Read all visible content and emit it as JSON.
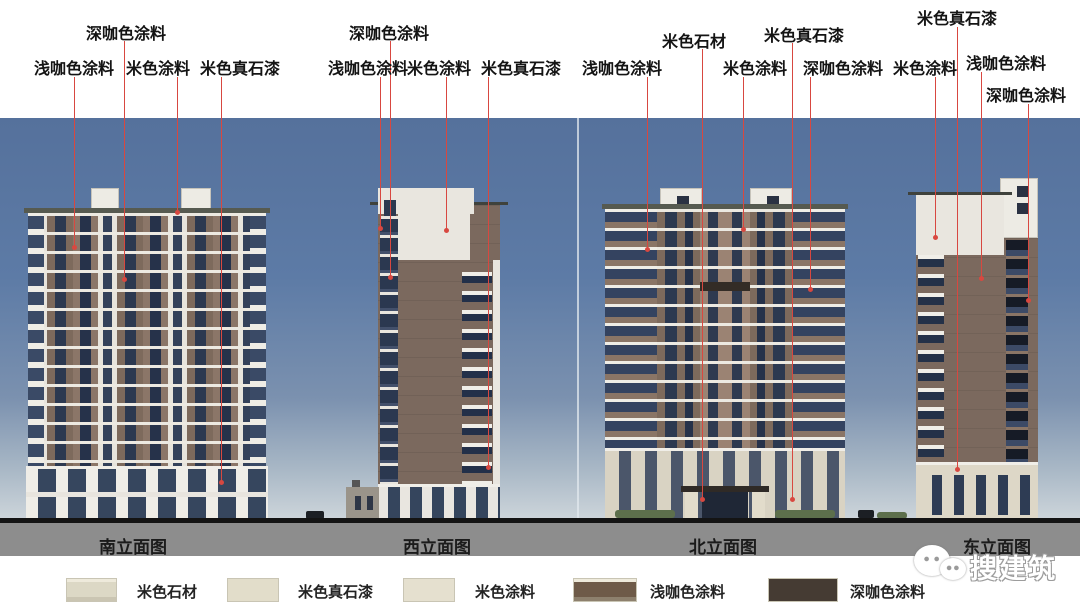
{
  "callouts": [
    {
      "label": "浅咖色涂料",
      "elevation": "南立面图"
    },
    {
      "label": "深咖色涂料",
      "elevation": "南立面图"
    },
    {
      "label": "米色涂料",
      "elevation": "南立面图"
    },
    {
      "label": "米色真石漆",
      "elevation": "南立面图"
    },
    {
      "label": "浅咖色涂料",
      "elevation": "西立面图"
    },
    {
      "label": "深咖色涂料",
      "elevation": "西立面图"
    },
    {
      "label": "米色涂料",
      "elevation": "西立面图"
    },
    {
      "label": "米色真石漆",
      "elevation": "西立面图"
    },
    {
      "label": "浅咖色涂料",
      "elevation": "北立面图"
    },
    {
      "label": "米色石材",
      "elevation": "北立面图"
    },
    {
      "label": "米色涂料",
      "elevation": "北立面图"
    },
    {
      "label": "米色真石漆",
      "elevation": "北立面图"
    },
    {
      "label": "深咖色涂料",
      "elevation": "北立面图"
    },
    {
      "label": "米色涂料",
      "elevation": "东立面图"
    },
    {
      "label": "米色真石漆",
      "elevation": "东立面图"
    },
    {
      "label": "浅咖色涂料",
      "elevation": "东立面图"
    },
    {
      "label": "深咖色涂料",
      "elevation": "东立面图"
    }
  ],
  "elevations": [
    {
      "name": "南立面图"
    },
    {
      "name": "西立面图"
    },
    {
      "name": "北立面图"
    },
    {
      "name": "东立面图"
    }
  ],
  "legend": {
    "items": [
      {
        "label": "米色石材",
        "color": "#dcd8c5"
      },
      {
        "label": "米色真石漆",
        "color": "#e2ddca"
      },
      {
        "label": "米色涂料",
        "color": "#e5e0cf"
      },
      {
        "label": "浅咖色涂料",
        "color": "#6e5a48"
      },
      {
        "label": "深咖色涂料",
        "color": "#453b33"
      }
    ]
  },
  "watermark": {
    "text": "搜建筑",
    "icon": "wechat-chat-bubbles"
  },
  "colors": {
    "callout_line": "#d84840",
    "sky_top": "#55719c",
    "sky_bottom": "#ccd4da",
    "ground_band": "#8d8d8d",
    "ground_line": "#141414"
  }
}
